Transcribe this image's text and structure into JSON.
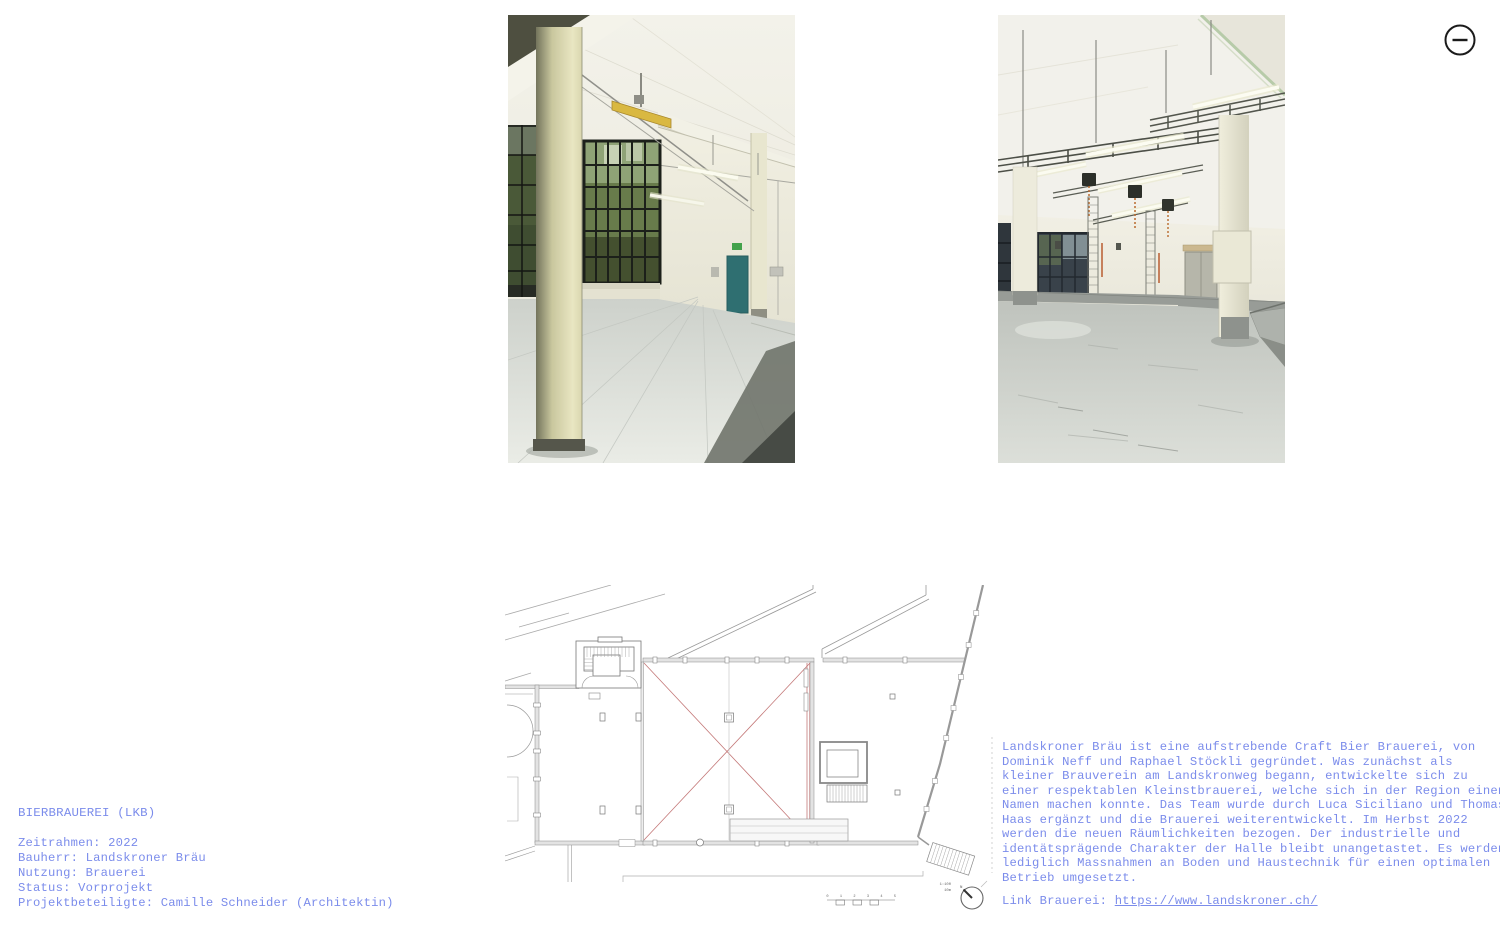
{
  "icons": {
    "collapse": "minus-circle-icon"
  },
  "project_info": {
    "title": "BIERBRAUEREI (LKB)",
    "details": [
      "Zeitrahmen: 2022",
      "Bauherr: Landskroner Bräu",
      "Nutzung: Brauerei",
      "Status: Vorprojekt",
      "Projektbeteiligte: Camille Schneider (Architektin)"
    ]
  },
  "description": {
    "lines": [
      "Landskroner Bräu ist eine aufstrebende Craft Bier Brauerei, von",
      "Dominik Neff und Raphael Stöckli gegründet. Was zunächst als",
      "kleiner Brauverein am Landskronweg begann, entwickelte sich zu",
      "einer respektablen Kleinstbrauerei, welche sich in der Region einen",
      "Namen machen konnte. Das Team wurde durch Luca Siciliano und Thomas",
      "Haas ergänzt und die Brauerei weiterentwickelt. Im Herbst 2022",
      "werden die neuen Räumlichkeiten bezogen. Der industrielle und",
      "identätsprägende Charakter der Halle bleibt unangetastet. Es werden",
      "lediglich Massnahmen an Boden und Haustechnik für einen optimalen",
      "Betrieb umgesetzt."
    ],
    "link_prefix": "Link Brauerei: ",
    "link_url_text": "https://www.landskroner.ch/"
  },
  "floor_plan": {
    "scale_label": "1:100",
    "scale_length_label": "10m",
    "scale_ticks": [
      "0",
      "1",
      "2",
      "3",
      "4",
      "5"
    ],
    "north_label": "N"
  },
  "images": {
    "photo1_alt": "Empty industrial hall with pale yellow columns, steel framed windows and teal door",
    "photo2_alt": "Industrial hall with overhead pipe racks, fluorescent tubes and chain hoists"
  },
  "colors": {
    "text_blue": "#7b8ceb",
    "icon_black": "#1b1b1b",
    "plan_red": "#c47878",
    "plan_gray": "#8a8a8a",
    "background": "#ffffff"
  }
}
